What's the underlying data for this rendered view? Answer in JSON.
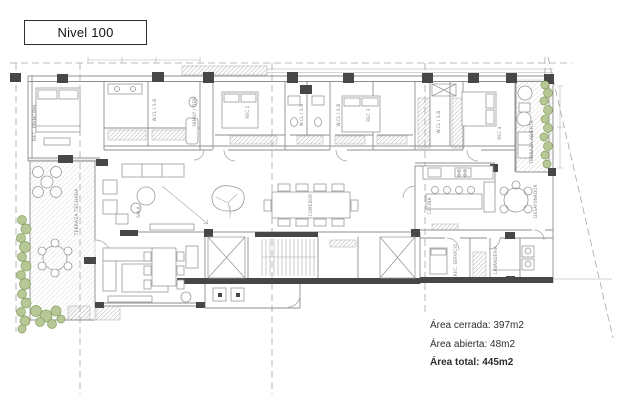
{
  "title": "Nivel 100",
  "areas": {
    "cerrada": "Área cerrada: 397m2",
    "abierta": "Área abierta: 48m2",
    "total": "Área total: 445m2"
  },
  "rooms": {
    "rec_principal": "REC. PRINCIPAL",
    "family_den": "FAMILY / DEN",
    "rec_2": "REC 2",
    "rec_3": "REC 3",
    "rec_4": "REC 4",
    "wcl_sb": "W.CL / S.B",
    "terraza_abierta": "TERRAZA ABIERTA",
    "terraza_techada": "TERRAZA TECHADA",
    "sala": "SALA",
    "comedor": "COMEDOR",
    "cocina": "COCINA",
    "desayunador": "DESAYUNADOR",
    "rec_servicio": "REC. SERVICIO",
    "lavanderia": "LAVANDERIA"
  },
  "colors": {
    "plan_line": "#8f8f8f",
    "dark_wall": "#474747",
    "plant_green": "#b7c796",
    "terrace_floor": "#f0eeea",
    "background": "#ffffff"
  }
}
